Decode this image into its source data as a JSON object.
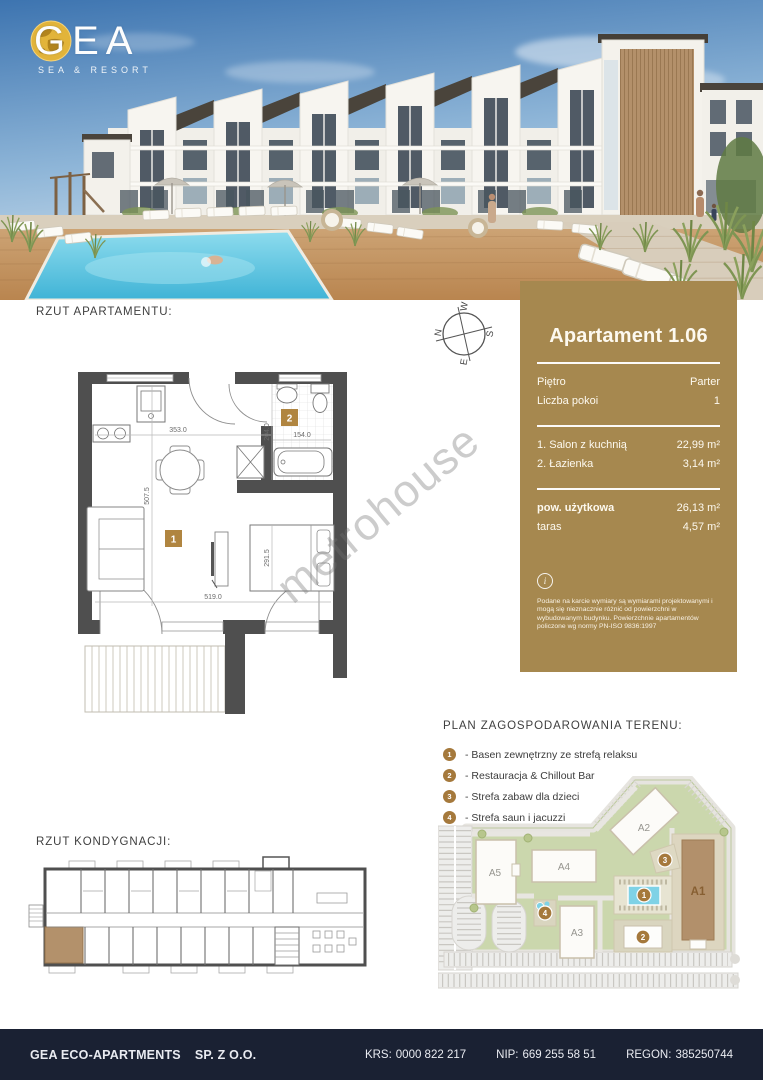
{
  "logo": {
    "name": "GEA",
    "tagline": "SEA & RESORT"
  },
  "sections": {
    "apartment_plan": "RZUT APARTAMENTU:",
    "site_plan": "PLAN ZAGOSPODAROWANIA TERENU:",
    "floor_layout": "RZUT KONDYGNACJI:"
  },
  "apartment_card": {
    "title": "Apartament 1.06",
    "info_rows": [
      {
        "label": "Piętro",
        "value": "Parter"
      },
      {
        "label": "Liczba pokoi",
        "value": "1"
      }
    ],
    "room_rows": [
      {
        "label": "1. Salon z kuchnią",
        "value": "22,99 m²"
      },
      {
        "label": "2. Łazienka",
        "value": "3,14 m²"
      }
    ],
    "summary_rows": [
      {
        "label": "pow. użytkowa",
        "value": "26,13 m²"
      },
      {
        "label": "taras",
        "value": "4,57 m²"
      }
    ],
    "info_icon": "i",
    "disclaimer": "Podane na karcie wymiary są wymiarami projektowanymi i mogą się nieznacznie różnić od powierzchni w wybudowanym budynku. Powierzchnie apartamentów policzone wg normy PN-ISO 9836:1997"
  },
  "floor_plan": {
    "rooms": [
      {
        "num": "1"
      },
      {
        "num": "2"
      }
    ],
    "dims": {
      "top_width": "353.0",
      "bath_width": "154.0",
      "bath_height": "204.0",
      "room_height": "507.5",
      "bed_width": "291.5",
      "bottom_width": "519.0"
    }
  },
  "compass": {
    "n": "N",
    "e": "E",
    "s": "S",
    "w": "W"
  },
  "site_legend": {
    "items": [
      {
        "num": "1",
        "label": "- Basen zewnętrzny ze strefą relaksu"
      },
      {
        "num": "2",
        "label": "- Restauracja & Chillout Bar"
      },
      {
        "num": "3",
        "label": "- Strefa zabaw dla dzieci"
      },
      {
        "num": "4",
        "label": "- Strefa saun i jacuzzi"
      }
    ]
  },
  "site_map": {
    "buildings": [
      {
        "label": "A1"
      },
      {
        "label": "A2"
      },
      {
        "label": "A3"
      },
      {
        "label": "A4"
      },
      {
        "label": "A5"
      }
    ],
    "markers": [
      "1",
      "2",
      "3",
      "4"
    ]
  },
  "watermark": "metrohouse",
  "footer": {
    "company": "GEA ECO-APARTMENTS",
    "company_suffix": "SP. Z O.O.",
    "krs_label": "KRS:",
    "krs": "0000 822 217",
    "nip_label": "NIP:",
    "nip": "669 255 58 51",
    "regon_label": "REGON:",
    "regon": "385250744"
  },
  "colors": {
    "accent_gold": "#a6884f",
    "marker_gold": "#a5793c",
    "footer_navy": "#1a2133",
    "pool_blue": "#7fd2e6",
    "site_green": "#cbd7ad",
    "highlight_brown": "#b3916b"
  }
}
